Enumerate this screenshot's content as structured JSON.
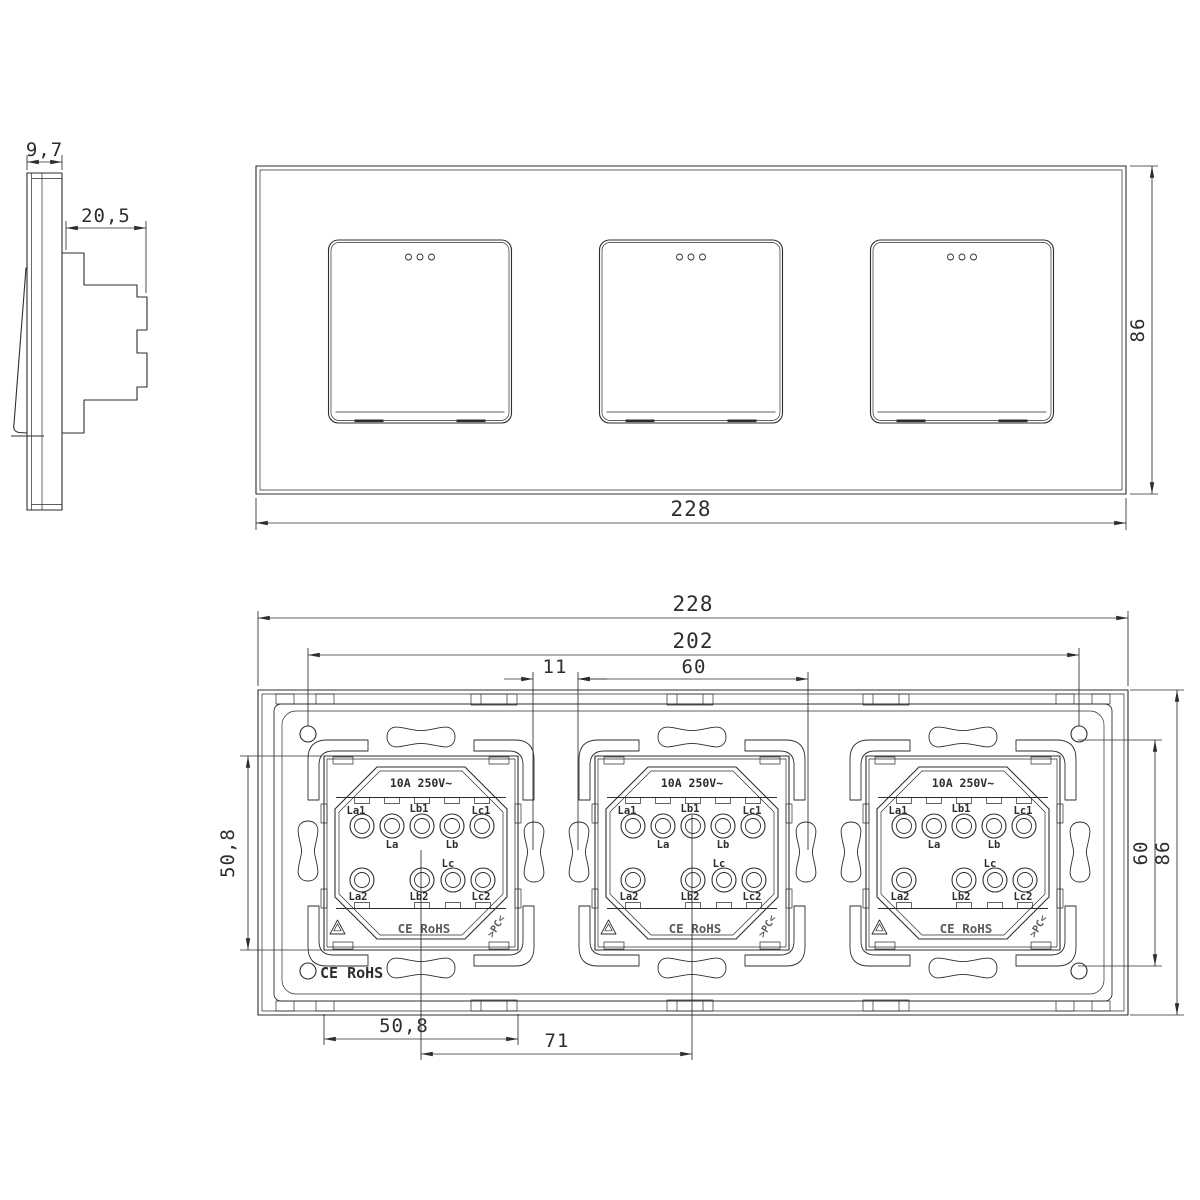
{
  "drawing_title": "triple-touch-switch-dimension-drawing",
  "side_view": {
    "thickness": "9,7",
    "depth": "20,5"
  },
  "front_view": {
    "overall_width": "228",
    "overall_height": "86"
  },
  "rear_view": {
    "overall_width": "228",
    "screw_span": "202",
    "module_outer_width": "60",
    "module_gap": "11",
    "module_height": "50,8",
    "module_outer_height": "60",
    "overall_height": "86",
    "module_width": "50,8",
    "module_spacing": "71",
    "plate_marking": "CE RoHS"
  },
  "module": {
    "rating": "10A 250V~",
    "terminals_top": [
      "La1",
      "La",
      "Lb1",
      "Lb",
      "Lc1"
    ],
    "terminals_bottom": [
      "La2",
      "Lb2",
      "Lc",
      "Lc2"
    ],
    "marking": "CE RoHS",
    "material": ">PC<"
  }
}
